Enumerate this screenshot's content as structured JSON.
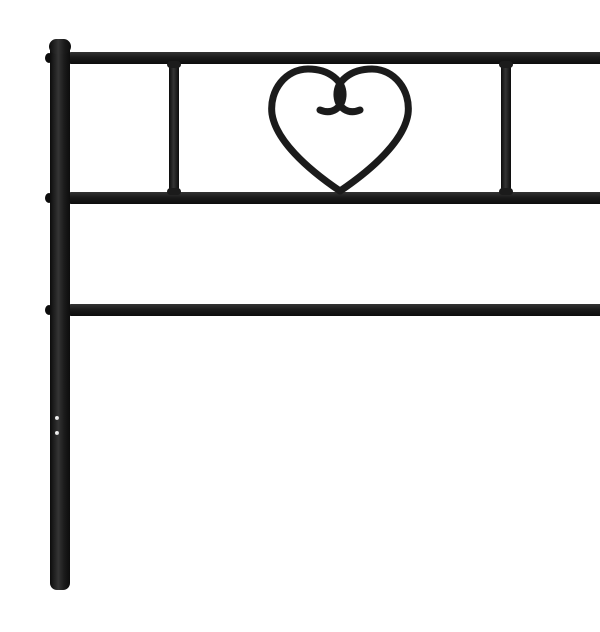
{
  "product": {
    "caption": "Black metal bed headboard with a decorative heart-shaped scroll ornament in the top panel, photographed on a plain white background",
    "object": "metal headboard",
    "color_name": "black",
    "ornament": "heart scroll with curled lobes",
    "parts": [
      {
        "label": "left post"
      },
      {
        "label": "right post"
      },
      {
        "label": "top rail"
      },
      {
        "label": "middle rail"
      },
      {
        "label": "lower rail"
      },
      {
        "label": "left divider bar"
      },
      {
        "label": "right divider bar"
      },
      {
        "label": "heart ornament"
      },
      {
        "label": "mounting screw holes"
      },
      {
        "label": "weld nubs at rail joints"
      }
    ]
  },
  "colors": {
    "background": "#ffffff",
    "metal": "#1b1b1b",
    "metal_dark": "#0c0c0c",
    "metal_light": "#343434",
    "hole": "#d9d9d9"
  }
}
